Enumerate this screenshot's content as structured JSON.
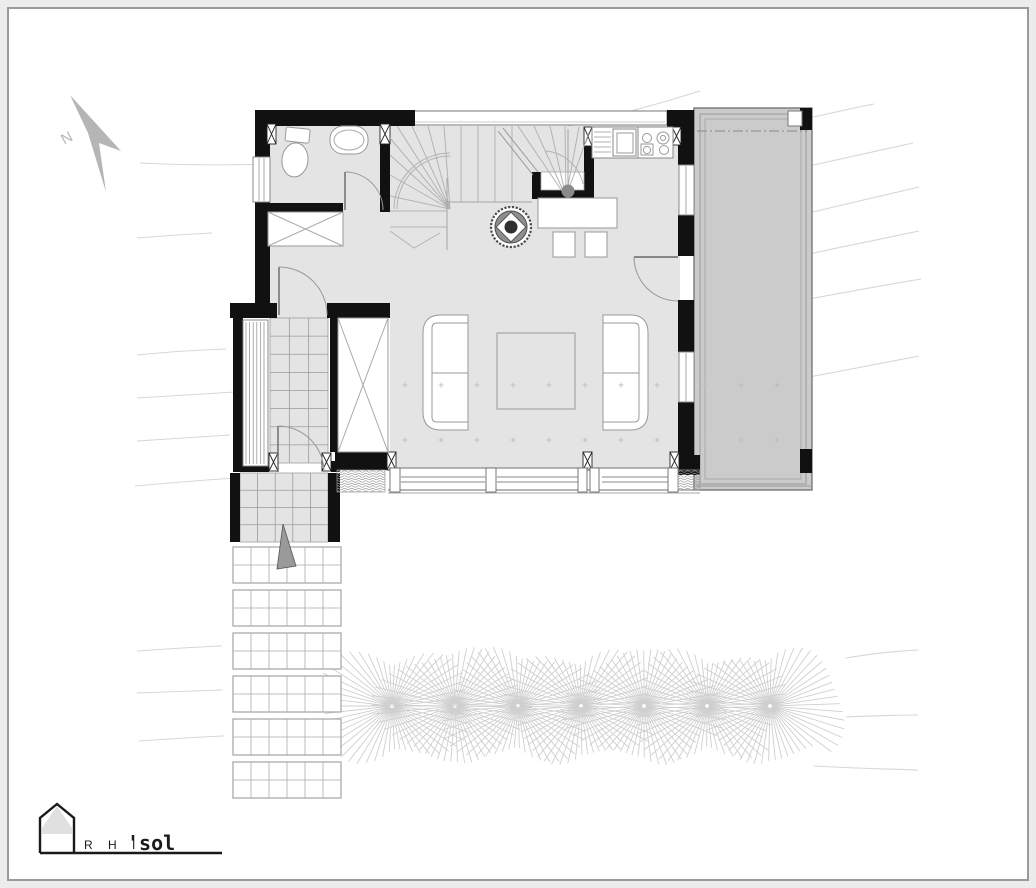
{
  "drawing": {
    "type": "architectural-floor-plan",
    "sheet_background": "#ffffff",
    "sheet_frame_color": "#9a9a9a",
    "margin_color": "#ececec"
  },
  "logo": {
    "prefix": "R H I",
    "suffix": "'sol"
  },
  "colors": {
    "wall": "#111111",
    "floor": "#e4e4e4",
    "terrace": "#cbcbcb",
    "furniture_stroke": "#999999",
    "tile_line": "#9a9a9a",
    "contour": "#d6d6d6",
    "tree": "#cfcfcf",
    "north_arrow": "#b5b5b5",
    "stair_line": "#b3b3b3",
    "dot": "#b8b8b8"
  },
  "patterns": {
    "contours": [
      "M140,163 C320,172 520,148 700,91",
      "M588,208 C625,196 662,180 694,166",
      "M809,118 C832,113 853,108 874,104",
      "M809,166 C845,158 880,150 913,143",
      "M809,213 C846,204 884,195 919,187",
      "M809,254 C846,246 884,238 919,231",
      "M809,299 C847,292 885,285 921,279",
      "M809,377 C846,370 884,363 919,356",
      "M846,658 C870,654 895,651 918,650",
      "M846,717 C870,716 894,715 918,715",
      "M814,766 C849,768 884,769 918,770",
      "M137,238 C162,236 188,234 212,233",
      "M137,355 C167,352 197,350 226,349",
      "M137,398 C170,396 203,394 235,392",
      "M137,441 C168,439 199,437 230,435",
      "M135,486 C169,483 203,480 236,478",
      "M137,651 C166,649 194,647 222,646",
      "M137,693 C166,692 194,691 222,690",
      "M139,741 C168,739 196,737 224,736"
    ],
    "trees": {
      "count": 7,
      "start_x": 392,
      "spacing": 63,
      "center_y": 706,
      "rays": 54,
      "base_len": 42,
      "horiz_boost": 26,
      "jitter_len": 16,
      "y_scale": 0.95
    },
    "vestibule_tiles": {
      "x": 270,
      "y": 318,
      "w": 58,
      "h": 145,
      "cols": 3,
      "rows": 8
    },
    "porch_tiles": {
      "x": 240,
      "y": 473,
      "w": 88,
      "h": 69,
      "cols": 5,
      "rows": 4
    },
    "path_mats": {
      "x": 233,
      "w": 108,
      "h": 36,
      "cols": 6,
      "rows": 2,
      "ys": [
        547,
        590,
        633,
        676,
        719,
        762
      ]
    },
    "bench_slats": {
      "x": 246,
      "y1": 322,
      "y2": 464,
      "count": 6,
      "step": 3.6
    },
    "floor_dots": {
      "rows": [
        385,
        440
      ],
      "x0": 405,
      "step": 36,
      "count": 8,
      "terrace_x0": 705,
      "terrace_step": 36,
      "terrace_count": 3
    }
  }
}
